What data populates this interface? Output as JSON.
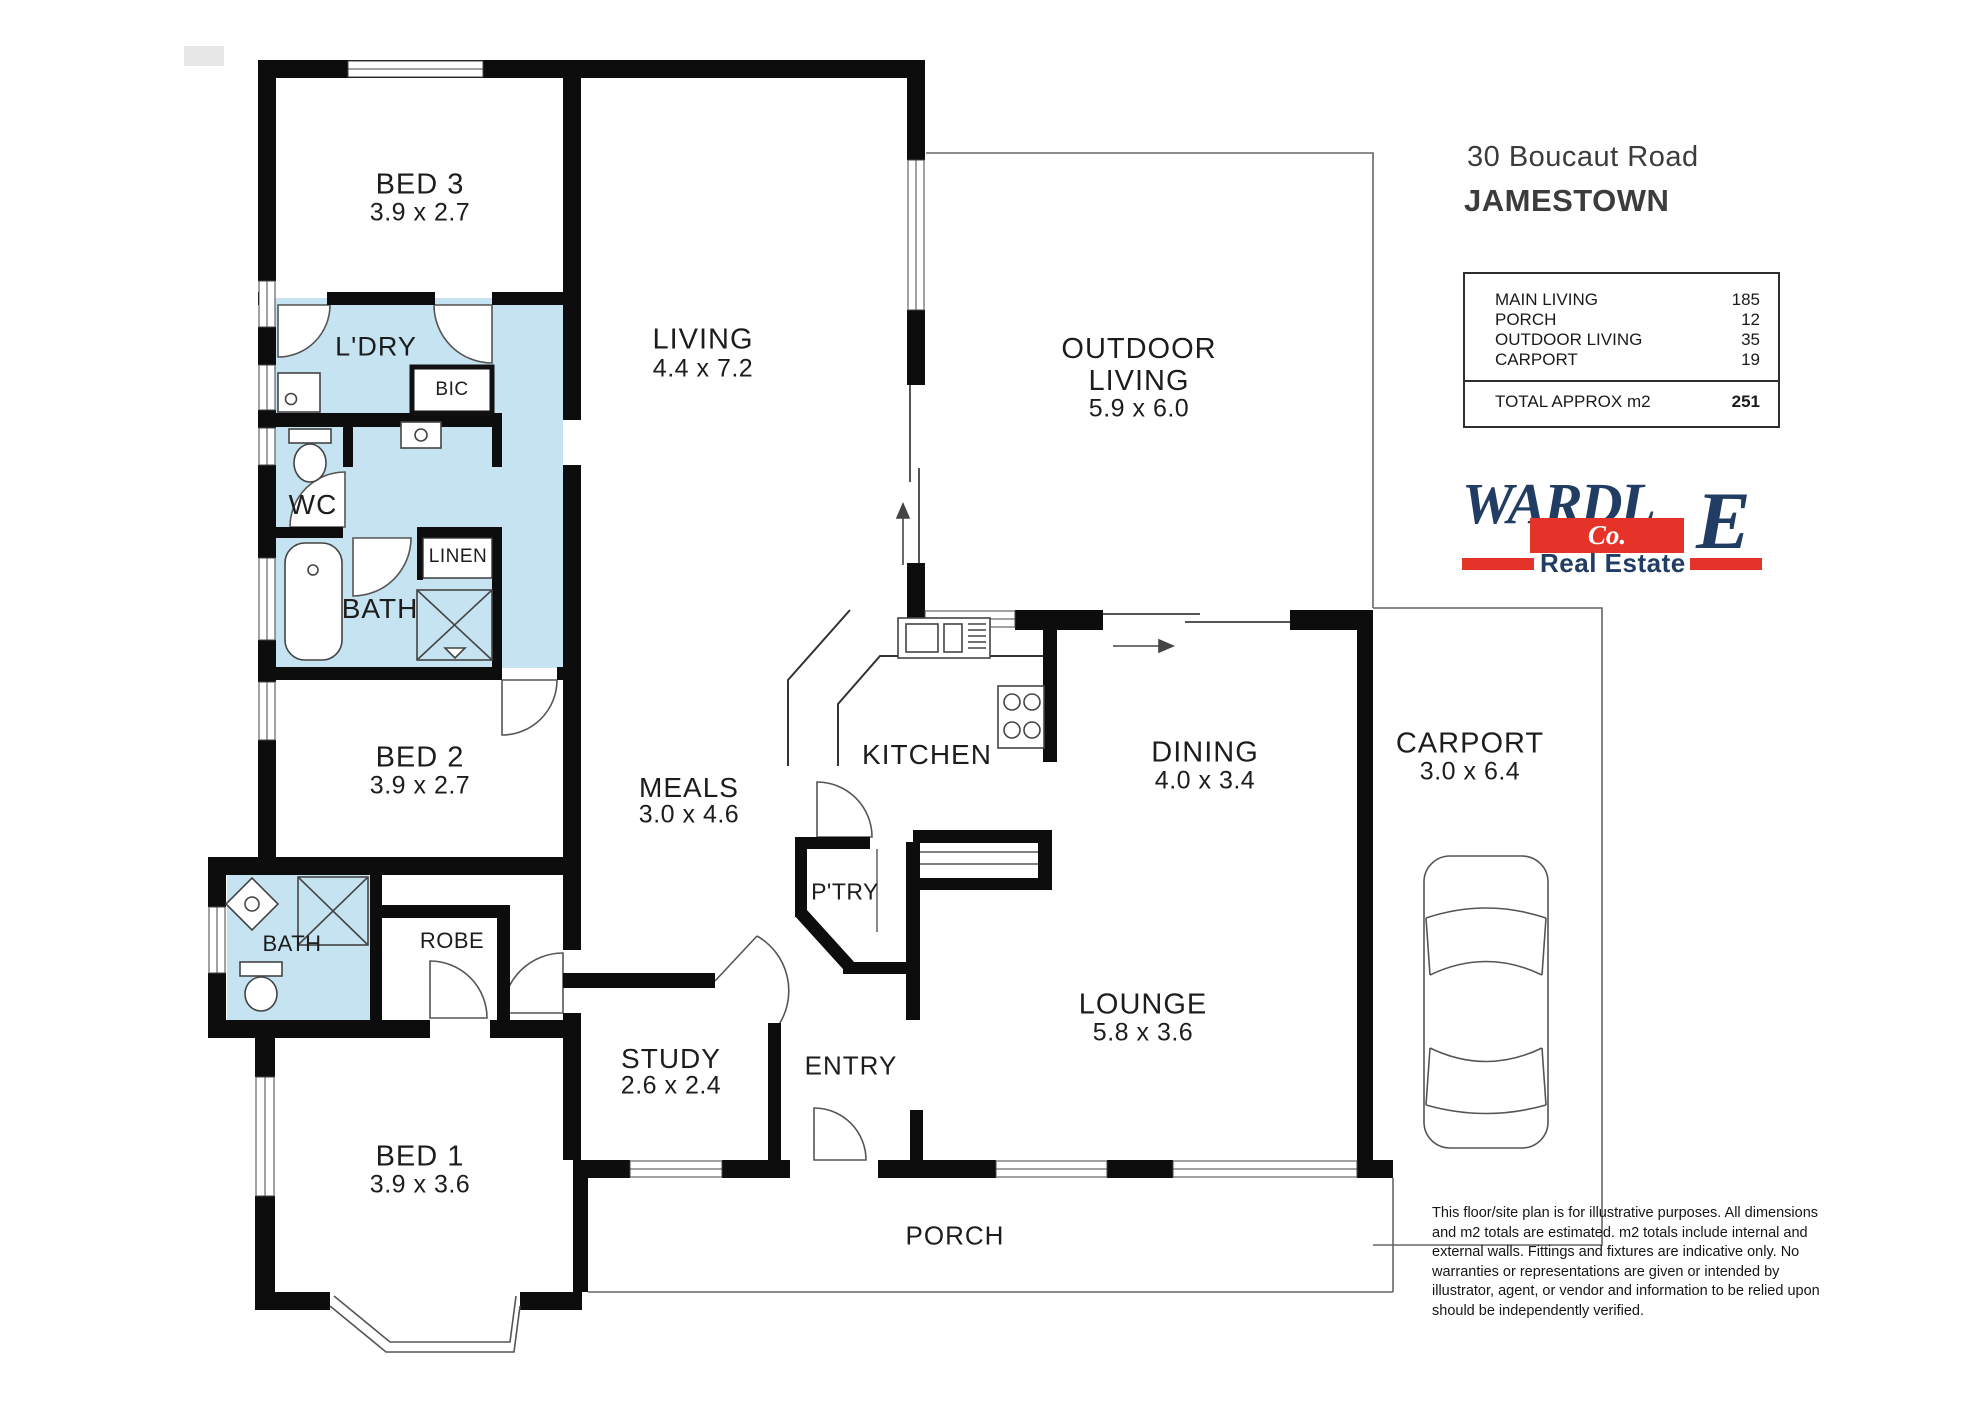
{
  "header": {
    "address": "30 Boucaut Road",
    "suburb": "JAMESTOWN"
  },
  "area_table": {
    "rows": [
      {
        "label": "MAIN LIVING",
        "value": "185"
      },
      {
        "label": "PORCH",
        "value": "12"
      },
      {
        "label": "OUTDOOR LIVING",
        "value": "35"
      },
      {
        "label": "CARPORT",
        "value": "19"
      }
    ],
    "total_label": "TOTAL APPROX m2",
    "total_value": "251"
  },
  "logo": {
    "name_main": "WARDL",
    "name_e": "E",
    "co": "Co.",
    "tagline": "Real Estate"
  },
  "rooms": {
    "bed3": {
      "name": "BED 3",
      "dims": "3.9 x 2.7"
    },
    "ldry": {
      "name": "L'DRY"
    },
    "bic": {
      "name": "BIC"
    },
    "wc": {
      "name": "WC"
    },
    "linen": {
      "name": "LINEN"
    },
    "bath": {
      "name": "BATH"
    },
    "living": {
      "name": "LIVING",
      "dims": "4.4 x 7.2"
    },
    "outdoor": {
      "name": "OUTDOOR LIVING",
      "dims": "5.9 x 6.0"
    },
    "bed2": {
      "name": "BED 2",
      "dims": "3.9 x 2.7"
    },
    "meals": {
      "name": "MEALS",
      "dims": "3.0 x 4.6"
    },
    "kitchen": {
      "name": "KITCHEN"
    },
    "ptry": {
      "name": "P'TRY"
    },
    "dining": {
      "name": "DINING",
      "dims": "4.0 x 3.4"
    },
    "carport": {
      "name": "CARPORT",
      "dims": "3.0 x 6.4"
    },
    "bath2": {
      "name": "BATH"
    },
    "robe": {
      "name": "ROBE"
    },
    "study": {
      "name": "STUDY",
      "dims": "2.6 x 2.4"
    },
    "entry": {
      "name": "ENTRY"
    },
    "bed1": {
      "name": "BED 1",
      "dims": "3.9 x 3.6"
    },
    "lounge": {
      "name": "LOUNGE",
      "dims": "5.8 x 3.6"
    },
    "porch": {
      "name": "PORCH"
    }
  },
  "disclaimer": "This floor/site plan is for illustrative purposes. All dimensions and m2 totals are estimated. m2 totals include internal and external walls. Fittings and fixtures are indicative only. No warranties or representations are given or intended by illustrator, agent, or vendor and information to be relied upon should be independently verified."
}
